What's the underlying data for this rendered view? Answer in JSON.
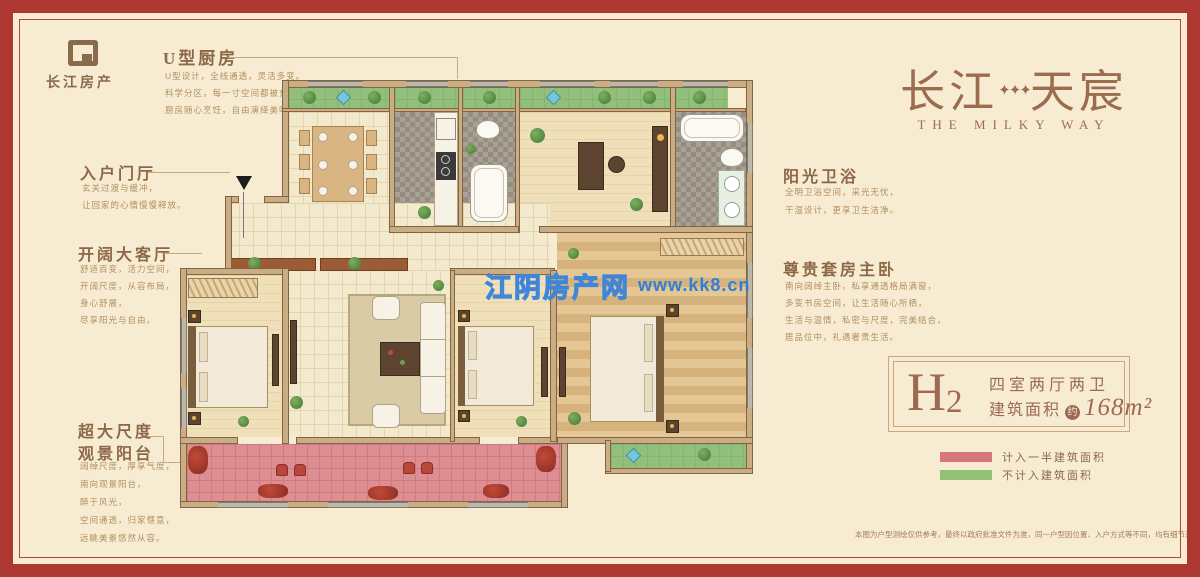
{
  "brand": {
    "name": "长江房产"
  },
  "title": {
    "cn_left": "长江",
    "stars": "✦✦✦",
    "cn_right": "天宸",
    "en": "THE MILKY WAY"
  },
  "watermark": {
    "site_name": "江阴房产网",
    "site_url": "www.kk8.cn",
    "blue": "#2f80d5"
  },
  "annotations": {
    "kitchen": {
      "heading": "U型厨房",
      "lines": [
        "U型设计，全线通透，灵活多变。",
        "科学分区，每一寸空间都被充分利用，",
        "厨房随心烹饪，自由演绎美味时光。"
      ]
    },
    "foyer": {
      "heading": "入户门厅",
      "lines": [
        "玄关过渡与缓冲，",
        "让回家的心情慢慢释放。"
      ]
    },
    "living": {
      "heading": "开阔大客厅",
      "lines": [
        "舒适百变，活力空间，",
        "开阔尺度，从容布局，",
        "身心舒展，",
        "尽享阳光与自由。"
      ]
    },
    "balcony": {
      "heading_line1": "超大尺度",
      "heading_line2": "观景阳台",
      "lines": [
        "阔绰尺度，厚享气度，",
        "南向观景阳台，",
        "醉于风光，",
        "空间通透，归家惬意，",
        "远眺美景悠然从容。"
      ]
    },
    "bath": {
      "heading": "阳光卫浴",
      "lines": [
        "全明卫浴空间，采光无忧，",
        "干湿设计，更享卫生洁净。"
      ]
    },
    "master": {
      "heading": "尊贵套房主卧",
      "lines": [
        "南向阔绰主卧，私享通透格局满窗，",
        "多变书房空间，让生活随心所栖，",
        "生活与温情，私密与尺度，完美结合，",
        "居品位中，礼遇奢贵生活。"
      ]
    }
  },
  "unit_card": {
    "unit_letter": "H",
    "unit_number": "2",
    "layout": "四室两厅两卫",
    "area_label": "建筑面积",
    "area_approx": "约",
    "area_value": "168m²"
  },
  "legend": {
    "item1": {
      "label": "计入一半建筑面积",
      "color": "#d4777e"
    },
    "item2": {
      "label": "不计入建筑面积",
      "color": "#90c278"
    }
  },
  "disclaimer": "本图为户型测绘仅供参考，最终以政府批准文件为准，同一户型因位置、入户方式等不同，均有细节差异各有不同。",
  "colors": {
    "frame_red": "#ad3832",
    "background_cream": "#f7ecd2",
    "brand_brown": "#8d6848",
    "title_brown": "#9c6c4e",
    "balcony_pink": "#dd8e92",
    "platform_green": "#92c07c",
    "wall_tan": "#c9ad85"
  }
}
